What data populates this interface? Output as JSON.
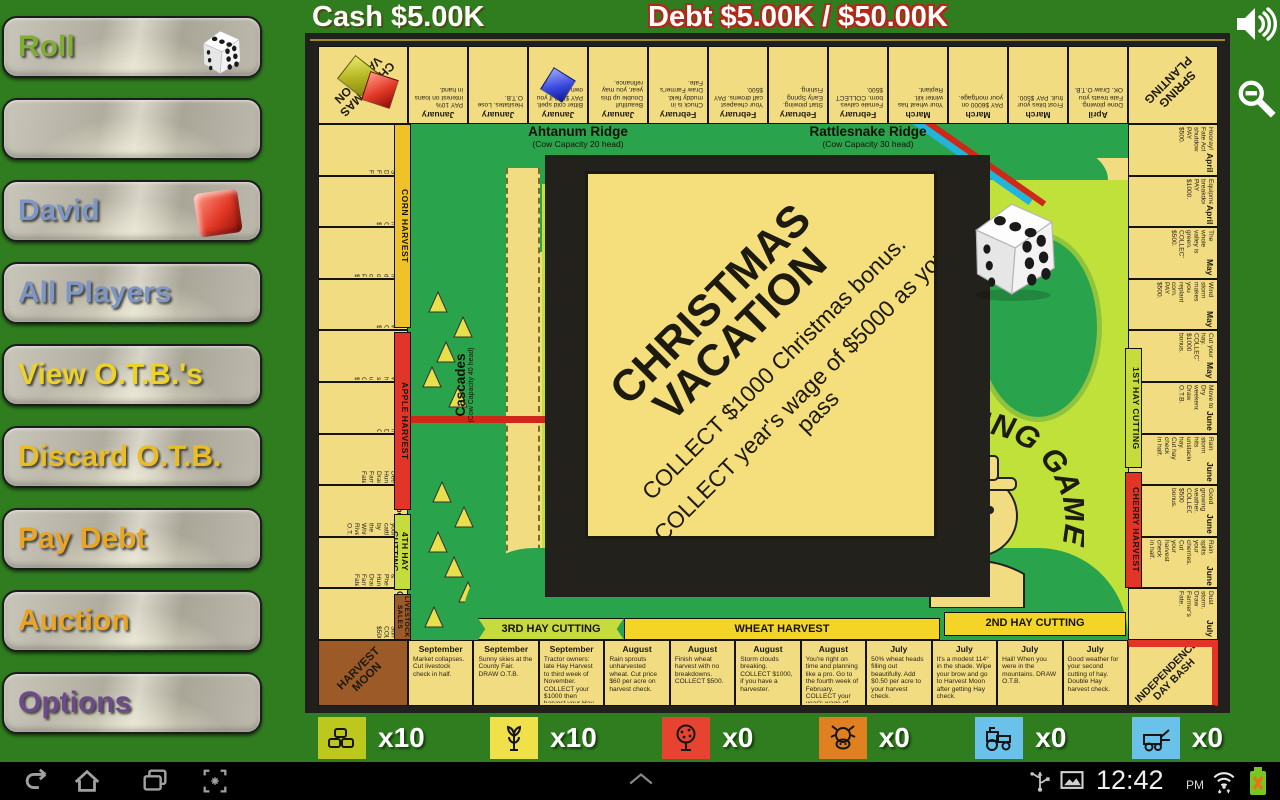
{
  "hud": {
    "cash_label": "Cash $5.00K",
    "debt_label": "Debt $5.00K / $50.00K",
    "icons": [
      "volume-icon",
      "zoom-out-icon"
    ]
  },
  "sidebar": {
    "buttons": [
      {
        "label": "Roll"
      },
      {
        "label": ""
      },
      {
        "label": "David"
      },
      {
        "label": "All Players"
      },
      {
        "label": "View O.T.B.'s"
      },
      {
        "label": "Discard O.T.B."
      },
      {
        "label": "Pay Debt"
      },
      {
        "label": "Auction"
      },
      {
        "label": "Options"
      }
    ]
  },
  "board": {
    "logo": "THE FARMING GAME",
    "credit": "©1979 George Rohrbacher",
    "corners": {
      "tl1": "CHRISTMAS",
      "tl2": "VACATION",
      "tr1": "SPRING",
      "tr2": "PLANTING",
      "br1": "INDEPENDENCE",
      "br2": "DAY BASH",
      "bl": "HARVEST MOON"
    },
    "ridges": {
      "ahtanum": {
        "name": "Ahtanum Ridge",
        "cap": "(Cow Capacity 20 head)"
      },
      "rattlesnake": {
        "name": "Rattlesnake Ridge",
        "cap": "(Cow Capacity 30 head)"
      },
      "toppenish": {
        "name": "Toppenish Ridge",
        "cap": "(Cow Capacity 50 head)"
      },
      "cascades": {
        "name": "Cascades",
        "cap": "(Cow Capacity 40 head)"
      }
    },
    "banners": {
      "corn": "CORN HARVEST",
      "apple": "APPLE HARVEST",
      "hay4": "4TH HAY CUTTING",
      "livestock": "LIVESTOCK SALES",
      "hay3": "3RD HAY CUTTING",
      "wheat": "WHEAT HARVEST",
      "hay2": "2ND HAY CUTTING",
      "hay1": "1ST HAY CUTTING",
      "cherry": "CHERRY HARVEST"
    },
    "top_row": [
      {
        "month": "January",
        "desc": "PAY 10% interest on loans in hand."
      },
      {
        "month": "January",
        "desc": "Hesitates. Lose O.T.B."
      },
      {
        "month": "January",
        "desc": "Bitter cold spell. PAY $500 if you own cows.",
        "piece": "blue"
      },
      {
        "month": "January",
        "desc": "Beautiful! Double up this year, you may refinance."
      },
      {
        "month": "February",
        "desc": "Chuck is in muddy field. Draw Farmer's Fate."
      },
      {
        "month": "February",
        "desc": "Your cheapest calf drowns. PAY $500."
      },
      {
        "month": "February",
        "desc": "Start plowing. Early Spring Fishing."
      },
      {
        "month": "February",
        "desc": "Female calves born. COLLECT $500."
      },
      {
        "month": "March",
        "desc": "Your wheat has winter kill. Replant."
      },
      {
        "month": "March",
        "desc": "PAY $6000 on your mortgage."
      },
      {
        "month": "March",
        "desc": "Frost bites your fruit. PAY $500."
      },
      {
        "month": "April",
        "desc": "Done plowing. Fate treats you OK. Draw O.T.B."
      }
    ],
    "left_col": [
      {
        "month": "December",
        "desc": "First Snow. Draw Farmer's Fate."
      },
      {
        "month": "December",
        "desc": "Corn harvesting. COLLECT $500."
      },
      {
        "month": "November",
        "desc": "Early freeze dries out corn. PAY $200."
      },
      {
        "month": "November",
        "desc": "Good weather. COLLECT $1000."
      },
      {
        "month": "November",
        "desc": "Good weather, harvest standing up. COLLECT $500."
      },
      {
        "month": "November",
        "desc": "Neighbor helps. Draw O.T.B."
      },
      {
        "month": "October",
        "desc": "Annual Deer Hunt. Draw Farmer's Fate."
      },
      {
        "month": "October",
        "desc": "Pack your cattle by the White River. O.T.B."
      },
      {
        "month": "October",
        "desc": "Quail & Pheasant Hunting. Draw Farmer's Fate."
      },
      {
        "month": "October",
        "desc": "Indian Summer. COLLECT $500."
      }
    ],
    "right_col": [
      {
        "month": "April",
        "desc": "Hooray! Fate Act shutdown. PAY $500."
      },
      {
        "month": "April",
        "desc": "Equipment breakdown. PAY $1000."
      },
      {
        "month": "May",
        "desc": "The whole valley is green. COLLECT $500."
      },
      {
        "month": "May",
        "desc": "Wind storm makes you replant corn. PAY $500."
      },
      {
        "month": "May",
        "desc": "Cut your hay. COLLECT $1000 bonus."
      },
      {
        "month": "June",
        "desc": "Move to Dry weekend. Draw O.T.B."
      },
      {
        "month": "June",
        "desc": "Rain storm hits unstacked hay. Cut hay check in half."
      },
      {
        "month": "June",
        "desc": "Good growing weather. COLLECT $500 bonus."
      },
      {
        "month": "June",
        "desc": "Rain splits your cherries. Cut your harvest check in half."
      },
      {
        "month": "July",
        "desc": "Dust storm. Draw Farmer's Fate."
      }
    ],
    "bottom_row": [
      {
        "month": "September",
        "desc": "Market collapses. Cut livestock check in half."
      },
      {
        "month": "September",
        "desc": "Sunny skies at the County Fair. DRAW O.T.B."
      },
      {
        "month": "September",
        "desc": "Tractor owners: late Hay Harvest to third week of November. COLLECT your $1000 then harvest your Hay."
      },
      {
        "month": "August",
        "desc": "Rain sprouts unharvested wheat. Cut price $60 per acre on harvest check."
      },
      {
        "month": "August",
        "desc": "Finish wheat harvest with no breakdowns. COLLECT $500."
      },
      {
        "month": "August",
        "desc": "Storm clouds breaking. COLLECT $1000, if you have a harvester."
      },
      {
        "month": "August",
        "desc": "You're right on time and planning like a pro. Go to the fourth week of February. COLLECT your year's wage of $5000."
      },
      {
        "month": "July",
        "desc": "50% wheat heads filling out beautifully. Add $0.50 per acre to your harvest check."
      },
      {
        "month": "July",
        "desc": "It's a modest 114° in the shade. Wipe your brow and go to Harvest Moon after getting Hay check."
      },
      {
        "month": "July",
        "desc": "Hail! When you were in the mountains. DRAW O.T.B."
      },
      {
        "month": "July",
        "desc": "Good weather for your second cutting of hay. Double Hay harvest check."
      }
    ]
  },
  "card": {
    "title1": "CHRISTMAS",
    "title2": "VACATION",
    "line1": "COLLECT $1000 Christmas bonus.",
    "line2": "COLLECT year's wage of $5000 as you pass"
  },
  "counters": [
    {
      "icon": "hay-bales",
      "bg": "#bdc81e",
      "count": "x10"
    },
    {
      "icon": "wheat-sheaf",
      "bg": "#f0e04a",
      "count": "x10"
    },
    {
      "icon": "fruit-tree",
      "bg": "#e64430",
      "count": "x0"
    },
    {
      "icon": "cow",
      "bg": "#e08020",
      "count": "x0"
    },
    {
      "icon": "tractor",
      "bg": "#6ac2ea",
      "count": "x0"
    },
    {
      "icon": "harvester",
      "bg": "#6ac2ea",
      "count": "x0"
    }
  ],
  "navbar": {
    "time": "12:42",
    "ampm": "PM"
  }
}
